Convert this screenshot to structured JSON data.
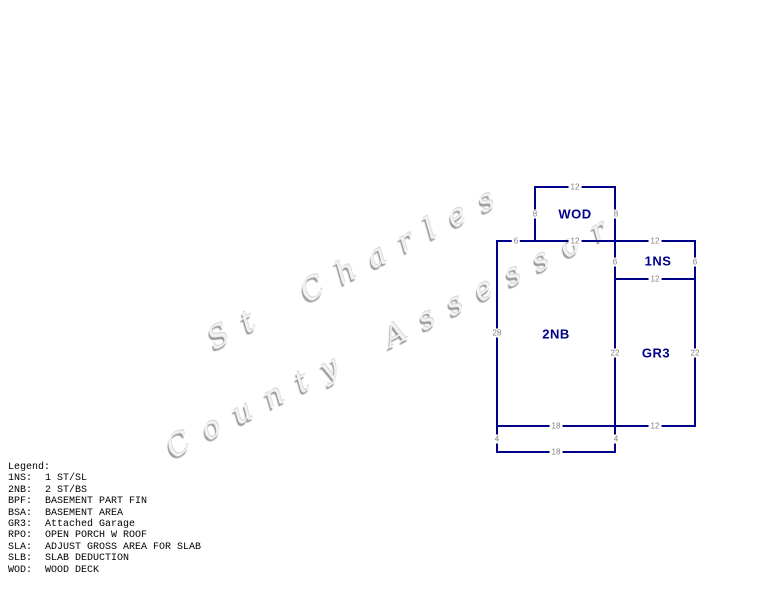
{
  "watermark": {
    "line1": "St Charles",
    "line2": "County Assessor"
  },
  "sketch": {
    "areas": {
      "wod": "WOD",
      "ns": "1NS",
      "nb": "2NB",
      "gr": "GR3"
    },
    "dims": {
      "wod_top": "12",
      "wod_left": "8",
      "wod_right": "8",
      "top_seg": "6",
      "wod_bottom": "12",
      "ns_top": "12",
      "ns_left": "6",
      "ns_right": "6",
      "ns_bottom": "12",
      "nb_left": "28",
      "gr_left": "22",
      "gr_right": "22",
      "nb_bottom": "18",
      "gr_bottom": "12",
      "ext_left": "4",
      "ext_right": "4",
      "ext_bottom": "18"
    }
  },
  "legend": {
    "title": "Legend:",
    "items": [
      {
        "code": "1NS:",
        "desc": "1 ST/SL"
      },
      {
        "code": "2NB:",
        "desc": "2 ST/BS"
      },
      {
        "code": "BPF:",
        "desc": "BASEMENT PART FIN"
      },
      {
        "code": "BSA:",
        "desc": "BASEMENT AREA"
      },
      {
        "code": "GR3:",
        "desc": "Attached Garage"
      },
      {
        "code": "RPO:",
        "desc": "OPEN PORCH W ROOF"
      },
      {
        "code": "SLA:",
        "desc": "ADJUST GROSS AREA FOR SLAB"
      },
      {
        "code": "SLB:",
        "desc": "SLAB DEDUCTION"
      },
      {
        "code": "WOD:",
        "desc": "WOOD DECK"
      }
    ]
  },
  "colors": {
    "wall": "#00008B",
    "area_label": "#00008B",
    "dimension_text": "#808080",
    "legend_text": "#000000",
    "watermark": "#9a9a9a",
    "background": "#ffffff"
  }
}
